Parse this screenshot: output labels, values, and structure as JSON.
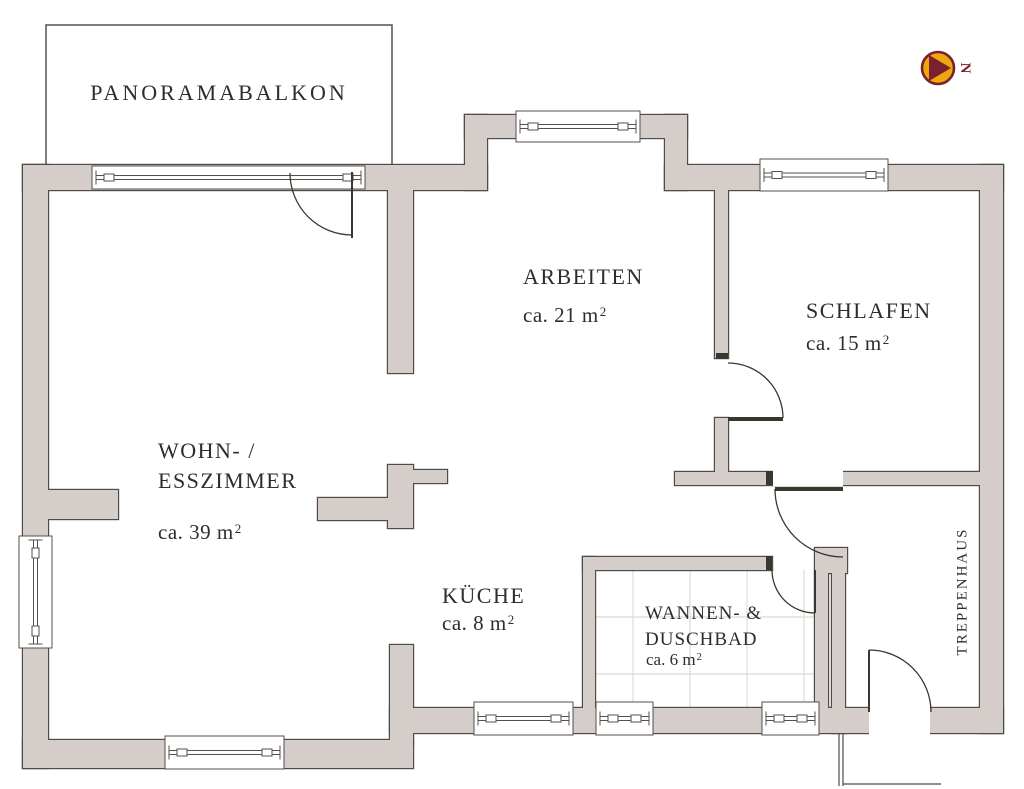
{
  "rooms": [
    {
      "id": "balcony",
      "label": "PANORAMABALKON",
      "area": ""
    },
    {
      "id": "arbeiten",
      "label": "ARBEITEN",
      "area": "ca. 21 m²"
    },
    {
      "id": "schlafen",
      "label": "SCHLAFEN",
      "area": "ca. 15 m²"
    },
    {
      "id": "wohn",
      "lines": [
        "WOHN- /",
        "ESSZIMMER"
      ],
      "area": "ca. 39 m²"
    },
    {
      "id": "kueche",
      "label": "KÜCHE",
      "area": "ca. 8 m²"
    },
    {
      "id": "bad",
      "lines": [
        "WANNEN- &",
        "DUSCHBAD"
      ],
      "area": "ca. 6 m²"
    },
    {
      "id": "treppenhaus",
      "label": "TREPPENHAUS",
      "area": ""
    }
  ],
  "compass": {
    "label": "N"
  },
  "colors": {
    "wall_fill": "#d4cdc9",
    "wall_line": "#504b47",
    "window_line": "#55504d",
    "door_line": "#3a372f",
    "tile_line": "#dedbd7",
    "text": "#2f2d29",
    "compass_gold": "#eda80c",
    "compass_maroon": "#7a2130"
  }
}
